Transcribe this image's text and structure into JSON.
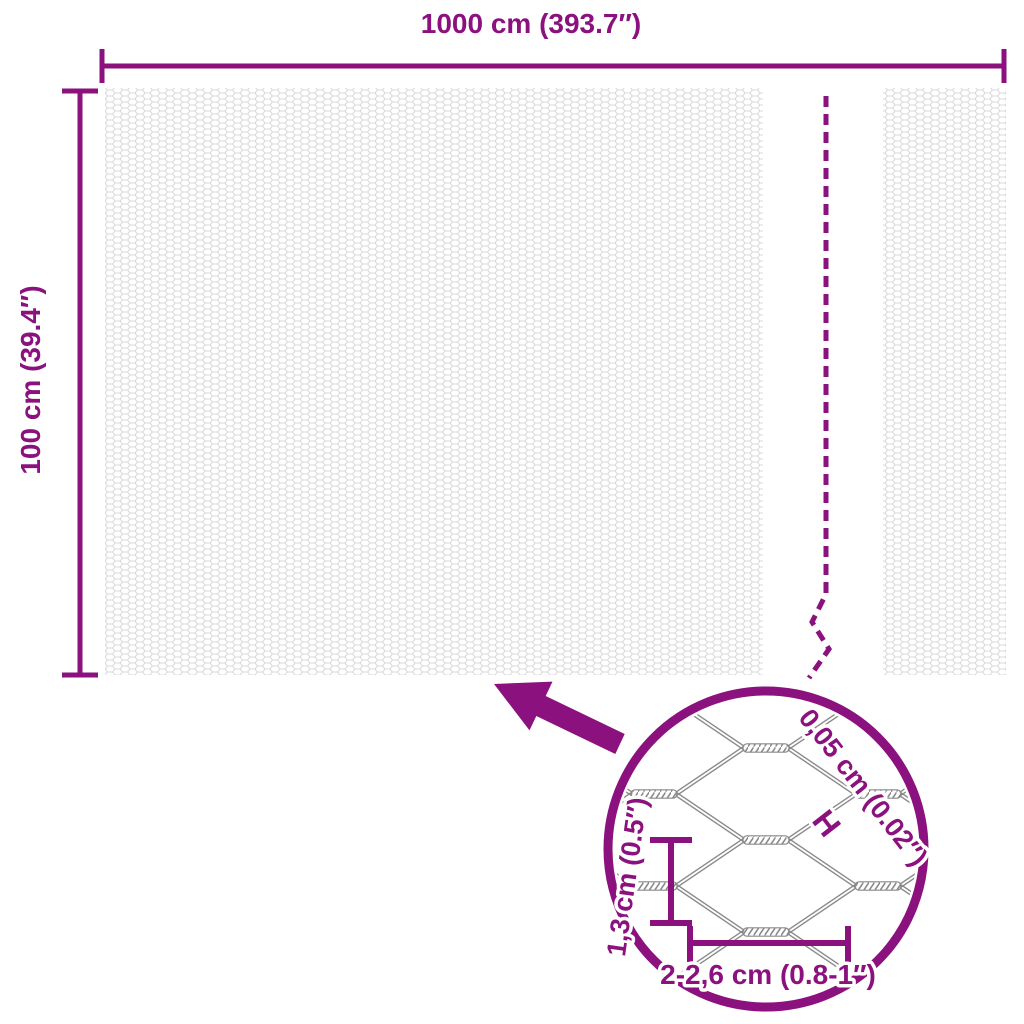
{
  "colors": {
    "accent": "#8B117E",
    "mesh_texture": "#D9D9D9",
    "wire_gray": "#8A8A8A",
    "background": "#FFFFFF"
  },
  "overall_dimensions": {
    "width_label": "1000 cm (393.7″)",
    "height_label": "100 cm (39.4″)"
  },
  "detail_view": {
    "wire_diameter_label": "0,05 cm (0.02″)",
    "wire_thickness_marker": "H",
    "cell_height_label": "1,3 cm (0.5″)",
    "cell_width_label": "2-2,6 cm (0.8-1″)"
  }
}
